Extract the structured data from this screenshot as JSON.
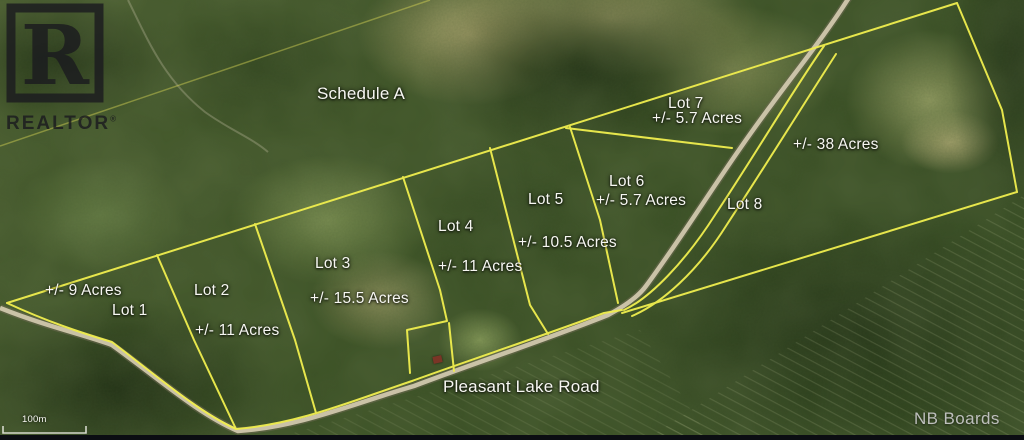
{
  "watermark": {
    "logo_letter": "R",
    "brand": "REALTOR",
    "registered": "®"
  },
  "map": {
    "schedule_label": "Schedule A",
    "road_label": "Pleasant Lake Road",
    "scale_label": "100m",
    "lots": [
      {
        "name": "Lot 1",
        "acreage": "+/- 9 Acres"
      },
      {
        "name": "Lot 2",
        "acreage": "+/- 11 Acres"
      },
      {
        "name": "Lot 3",
        "acreage": "+/- 15.5 Acres"
      },
      {
        "name": "Lot 4",
        "acreage": "+/- 11 Acres"
      },
      {
        "name": "Lot 5",
        "acreage": "+/- 10.5 Acres"
      },
      {
        "name": "Lot 6",
        "acreage": "+/- 5.7 Acres"
      },
      {
        "name": "Lot 7",
        "acreage": "+/- 5.7 Acres"
      },
      {
        "name": "Lot 8",
        "acreage": "+/- 38 Acres"
      }
    ]
  },
  "footer": {
    "brand": "NB Boards"
  },
  "colors": {
    "boundary": "#f0ee4e",
    "road": "#d6cdb2",
    "label_text": "#f7f7f2",
    "watermark": "#1b1b1f",
    "footer_text": "#c9c9c9"
  }
}
